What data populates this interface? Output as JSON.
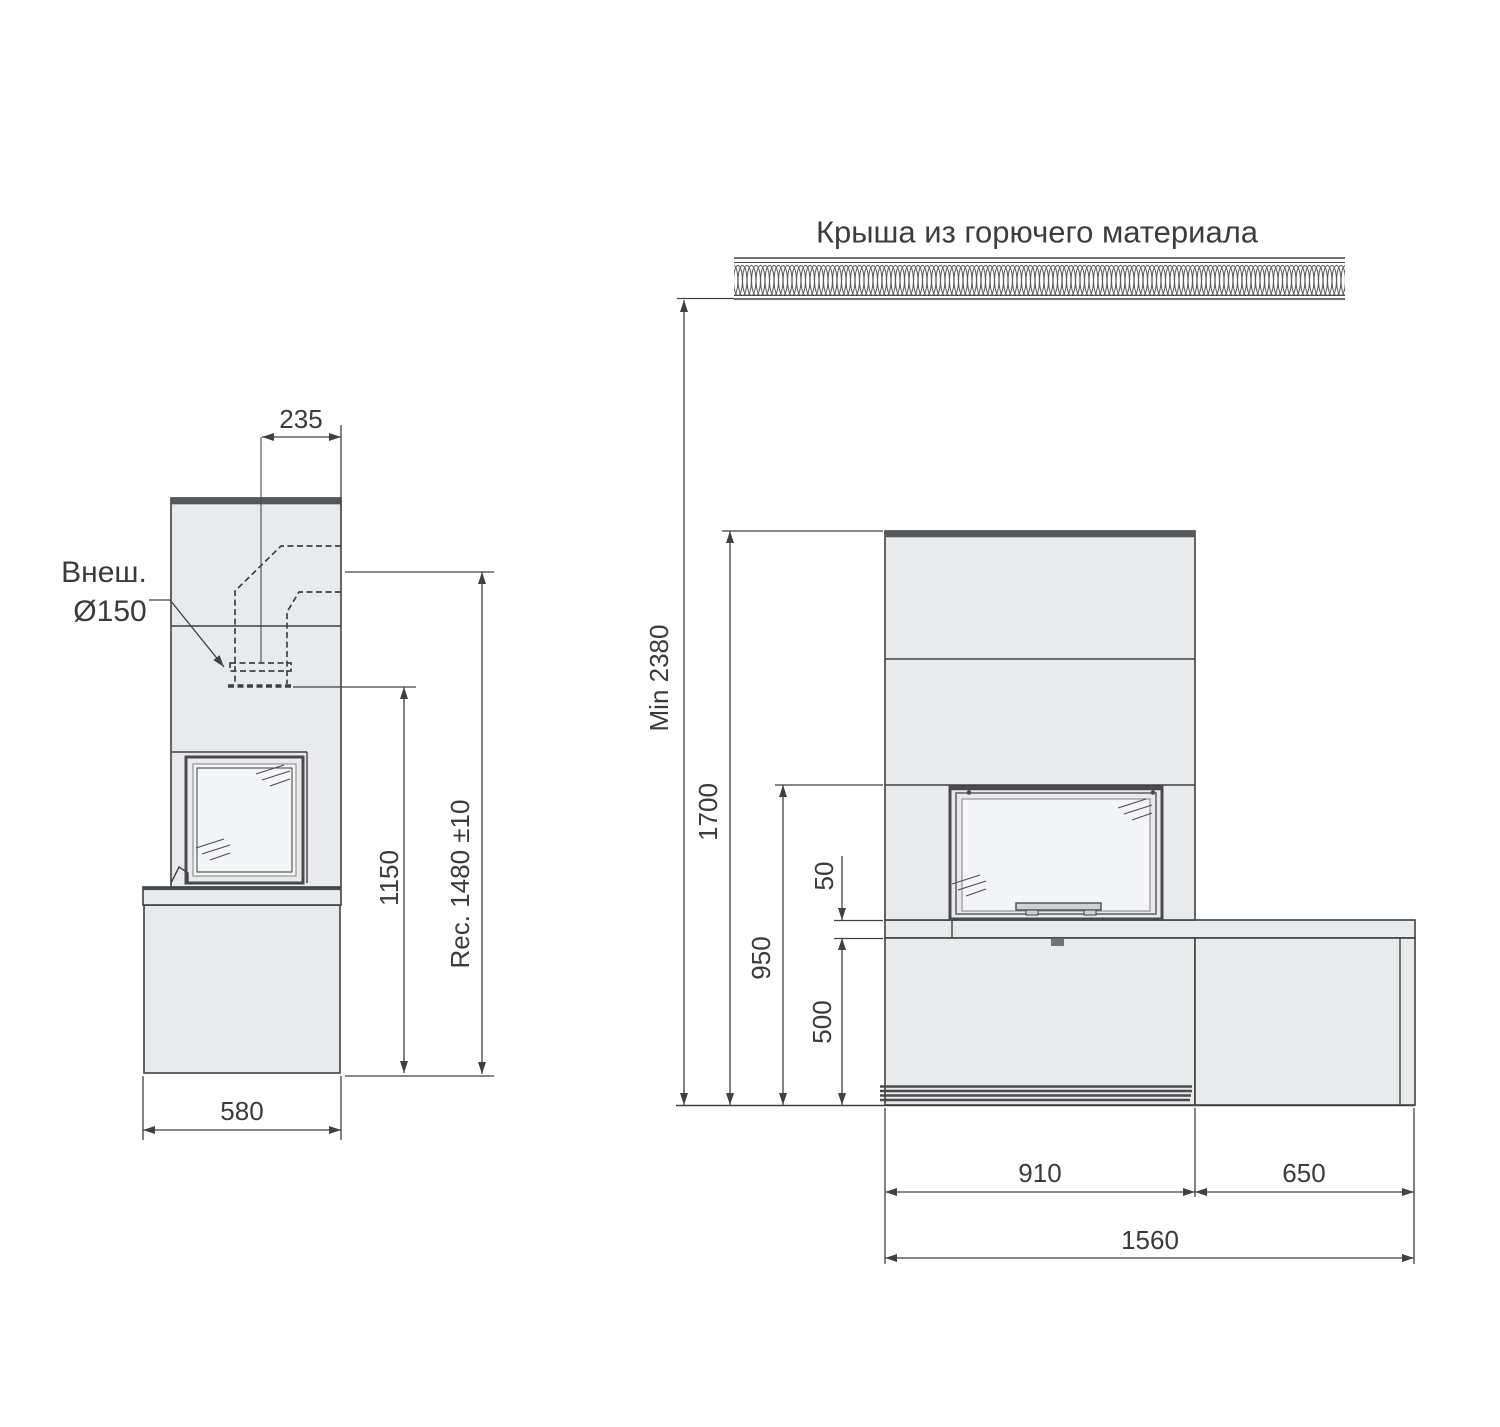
{
  "title": "Крыша из горючего материала",
  "callout": {
    "line1": "Внеш.",
    "line2": "Ø150"
  },
  "side_view": {
    "dims": {
      "flue_offset": "235",
      "flue_height": "1150",
      "rec_height": "Rec. 1480 ±10",
      "depth": "580"
    }
  },
  "front_view": {
    "dims": {
      "min_ceiling": "Min 2380",
      "body_height": "1700",
      "opening_height": "950",
      "bench_thickness": "50",
      "bench_height": "500",
      "body_width": "910",
      "bench_extension": "650",
      "total_width": "1560"
    }
  },
  "colors": {
    "background": "#ffffff",
    "fill": "#e9eaec",
    "glass": "#f4f5f6",
    "line": "#3f4142",
    "dark_cap": "#57585a",
    "text": "#3a3b3d"
  }
}
